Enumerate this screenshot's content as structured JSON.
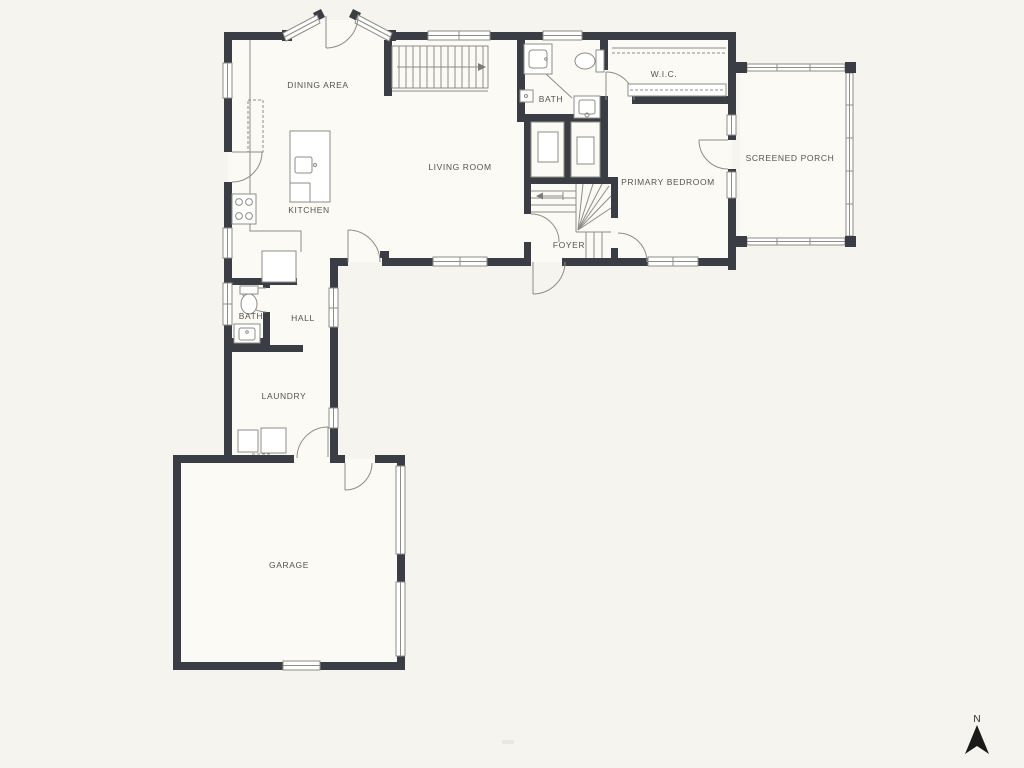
{
  "plan": {
    "background": "#f5f4ee",
    "wall_color": "#3a3d43",
    "line_color": "#8d8d86",
    "text_color": "#55544e",
    "floor_color": "#fbfaf5"
  },
  "rooms": {
    "dining": {
      "label": "DINING AREA"
    },
    "kitchen": {
      "label": "KITCHEN"
    },
    "living": {
      "label": "LIVING ROOM"
    },
    "bath_upper": {
      "label": "BATH"
    },
    "wic": {
      "label": "W.I.C."
    },
    "primary_bedroom": {
      "label": "PRIMARY BEDROOM"
    },
    "screened_porch": {
      "label": "SCREENED PORCH"
    },
    "foyer": {
      "label": "FOYER"
    },
    "hall": {
      "label": "HALL"
    },
    "bath_hall": {
      "label": "BATH"
    },
    "laundry": {
      "label": "LAUNDRY"
    },
    "garage": {
      "label": "GARAGE"
    }
  },
  "compass": {
    "label": "N"
  }
}
